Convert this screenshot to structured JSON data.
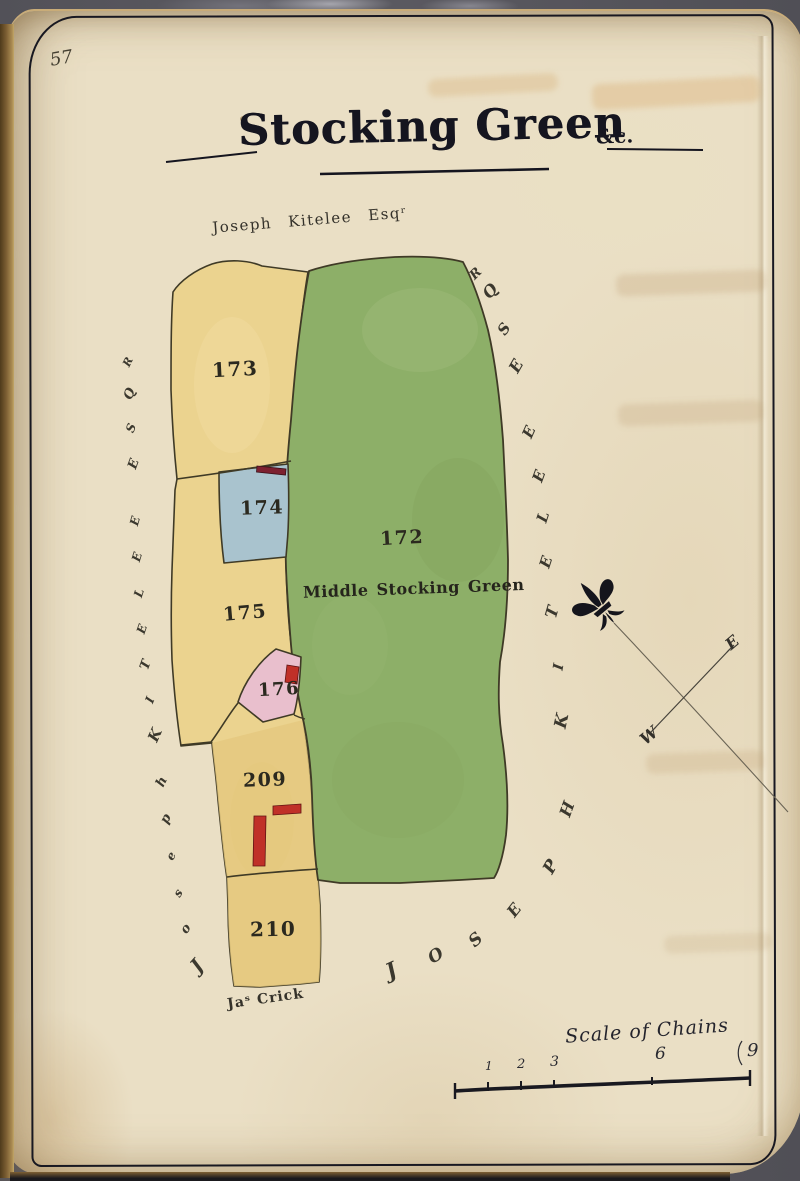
{
  "page_number": "57",
  "title": {
    "main": "Stocking Green",
    "suffix": "&c."
  },
  "top_owner": "Joseph Kitelee Esqʳ",
  "margin_owner_left": "Joseph Kitelee Esqr",
  "margin_owner_right": "Joseph Kitelee Esqr",
  "bottom_owner": "Jaˢ Crick",
  "parcels": {
    "p172": {
      "number": "172",
      "name": "Middle Stocking Green",
      "color": "#8daf68"
    },
    "p173": {
      "number": "173",
      "color": "#ebd38f"
    },
    "p174": {
      "number": "174",
      "color": "#a9c3ce"
    },
    "p175": {
      "number": "175",
      "color": "#ebd38f"
    },
    "p176": {
      "number": "176",
      "color": "#e9bfcd"
    },
    "p209": {
      "number": "209",
      "color": "#e5c87e"
    },
    "p210": {
      "number": "210",
      "color": "#e5c87e"
    }
  },
  "compass": {
    "east_label": "E",
    "west_label": "W"
  },
  "scale_bar": {
    "title": "Scale of Chains",
    "tick_labels": [
      "1",
      "2",
      "3",
      "6",
      "9"
    ]
  },
  "colors": {
    "ink": "#3f3a26",
    "frame_ink": "#181821",
    "building_red": "#c03028",
    "building_dark_red": "#7d2130",
    "paper": "#eadfc5"
  }
}
